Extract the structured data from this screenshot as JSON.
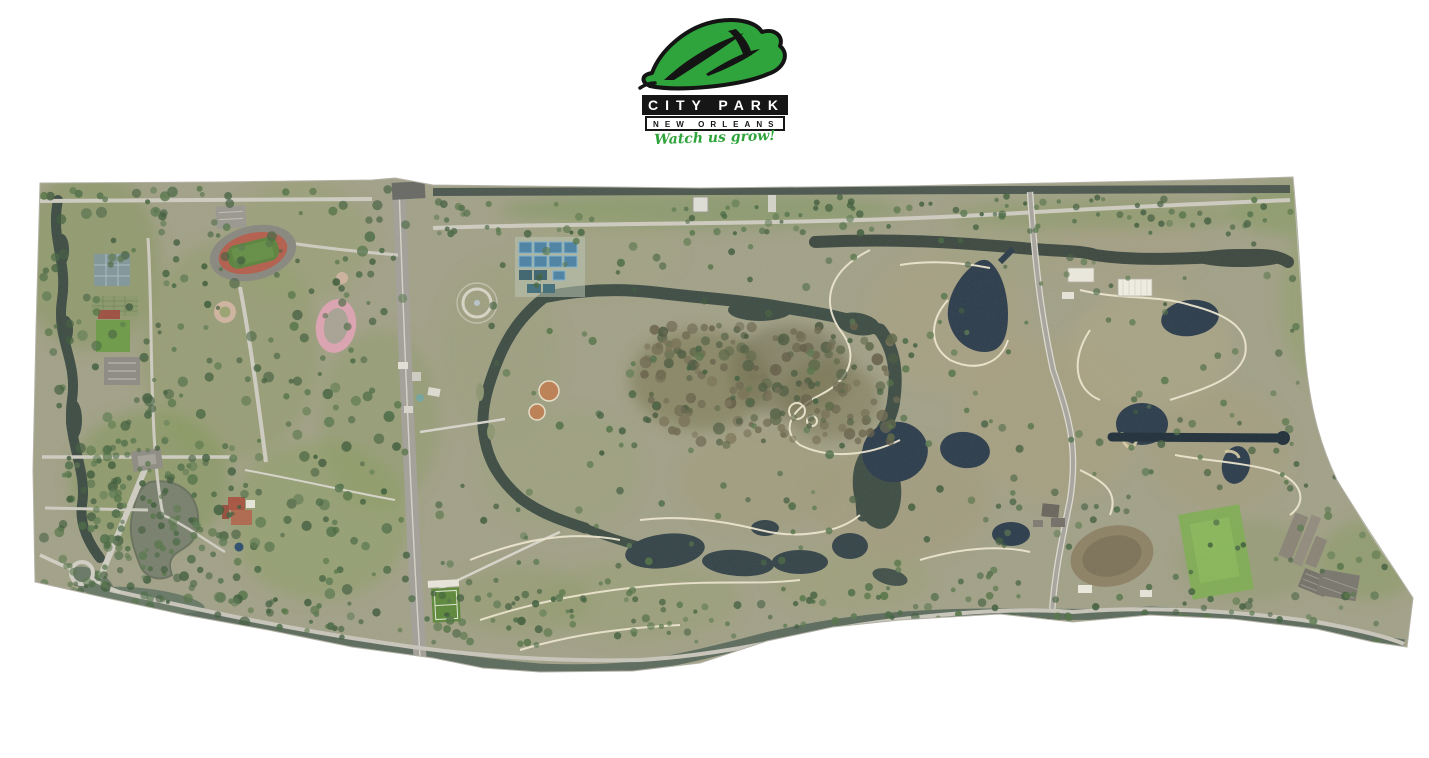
{
  "page": {
    "background": "#ffffff"
  },
  "logo": {
    "title": "CITY PARK",
    "subtitle": "NEW ORLEANS",
    "tagline": "Watch us grow!",
    "leaf_color": "#2fa43c",
    "title_bar_bg": "#161616",
    "title_color": "#ffffff",
    "subtitle_color": "#161616",
    "tagline_color": "#2fa43c"
  },
  "map": {
    "kind": "aerial-orthophoto",
    "subject": "New Orleans City Park aerial mosaic",
    "palette": {
      "base_ground": "#a3a289",
      "grass_green": "#86985f",
      "lawn_green": "#7f9a56",
      "dormant_tan": "#ab9f80",
      "scrub_brown": "#79744f",
      "tree_green": "#4a6a45",
      "forest_brown": "#6f6a52",
      "water_dark": "#3f4e46",
      "pond_navy": "#2e3e4d",
      "lake_murky": "#7a816f",
      "bayou_green": "#5c6b5e",
      "road_light": "#cfccc2",
      "road_major": "#a3a199",
      "path_cream": "#ede6d0",
      "track_red": "#b5604f",
      "track_pink": "#dca4b2",
      "tennis_blue": "#4f83a5",
      "tennis_teal": "#3f6672",
      "field_green": "#5f8a3d",
      "festival_green": "#7fae53",
      "building_white": "#f1efe4",
      "roof_red": "#a85643",
      "sand_tan": "#d9cda6"
    },
    "features": [
      {
        "name": "stadium-oval",
        "kind": "stadium with red track and green field",
        "color": "#b5604f"
      },
      {
        "name": "running-track",
        "kind": "pink 400m track",
        "color": "#dca4b2"
      },
      {
        "name": "tennis-center",
        "kind": "grid of blue tennis courts",
        "color": "#4f83a5"
      },
      {
        "name": "old-tennis-courts",
        "kind": "gray-blue court cluster",
        "color": "#7f96a2"
      },
      {
        "name": "softball-diamonds",
        "kind": "orange infield diamonds",
        "color": "#bd8055"
      },
      {
        "name": "soccer-field",
        "kind": "bright green field with white lines",
        "color": "#5f8a3d"
      },
      {
        "name": "festival-field",
        "kind": "large bright green lawn",
        "color": "#7fae53"
      },
      {
        "name": "driving-range",
        "kind": "bare earth oval",
        "color": "#8c7f63"
      },
      {
        "name": "big-lake",
        "kind": "murky curved lake",
        "color": "#7a816f"
      },
      {
        "name": "west-lagoon",
        "kind": "winding vertical lagoon",
        "color": "#3f4e46"
      },
      {
        "name": "scout-island-loop",
        "kind": "bayou loop around wooded island",
        "color": "#3f4e46"
      },
      {
        "name": "scout-island-forest",
        "kind": "brown leafless forest",
        "color": "#6f6a52"
      },
      {
        "name": "golf-ponds",
        "kind": "dark navy golf ponds with sand edges",
        "color": "#2e3e4d"
      },
      {
        "name": "straight-canal",
        "kind": "long straight dark canal",
        "color": "#22313c"
      },
      {
        "name": "top-canal",
        "kind": "canal along north boundary",
        "color": "#49544d"
      },
      {
        "name": "north-bayou",
        "kind": "bayou below north road",
        "color": "#3f4a42"
      },
      {
        "name": "south-bayou",
        "kind": "bayou along south boundary",
        "color": "#5c6b5e"
      },
      {
        "name": "marconi-drive",
        "kind": "wide vertical divided road",
        "color": "#a3a199"
      },
      {
        "name": "golf-drive",
        "kind": "curving north-south road",
        "color": "#a8a69e"
      },
      {
        "name": "oak-allee",
        "kind": "tree-lined diagonal avenue",
        "color": "#d0cdc3"
      },
      {
        "name": "traffic-circle",
        "kind": "roundabout at southwest corner",
        "color": "#cfccc2"
      },
      {
        "name": "museum-red-roof-building",
        "kind": "red tile roofed building",
        "color": "#a85643"
      },
      {
        "name": "maintenance-sheds",
        "kind": "white roofed buildings",
        "color": "#f1efe4"
      },
      {
        "name": "school-complex",
        "kind": "angled gray buildings with parking",
        "color": "#8b8578"
      },
      {
        "name": "popp-fountain-ring",
        "kind": "circular plaza ring",
        "color": "#d8d4c6"
      },
      {
        "name": "target-green-rings",
        "kind": "white practice circles",
        "color": "#ede6d0"
      }
    ]
  }
}
